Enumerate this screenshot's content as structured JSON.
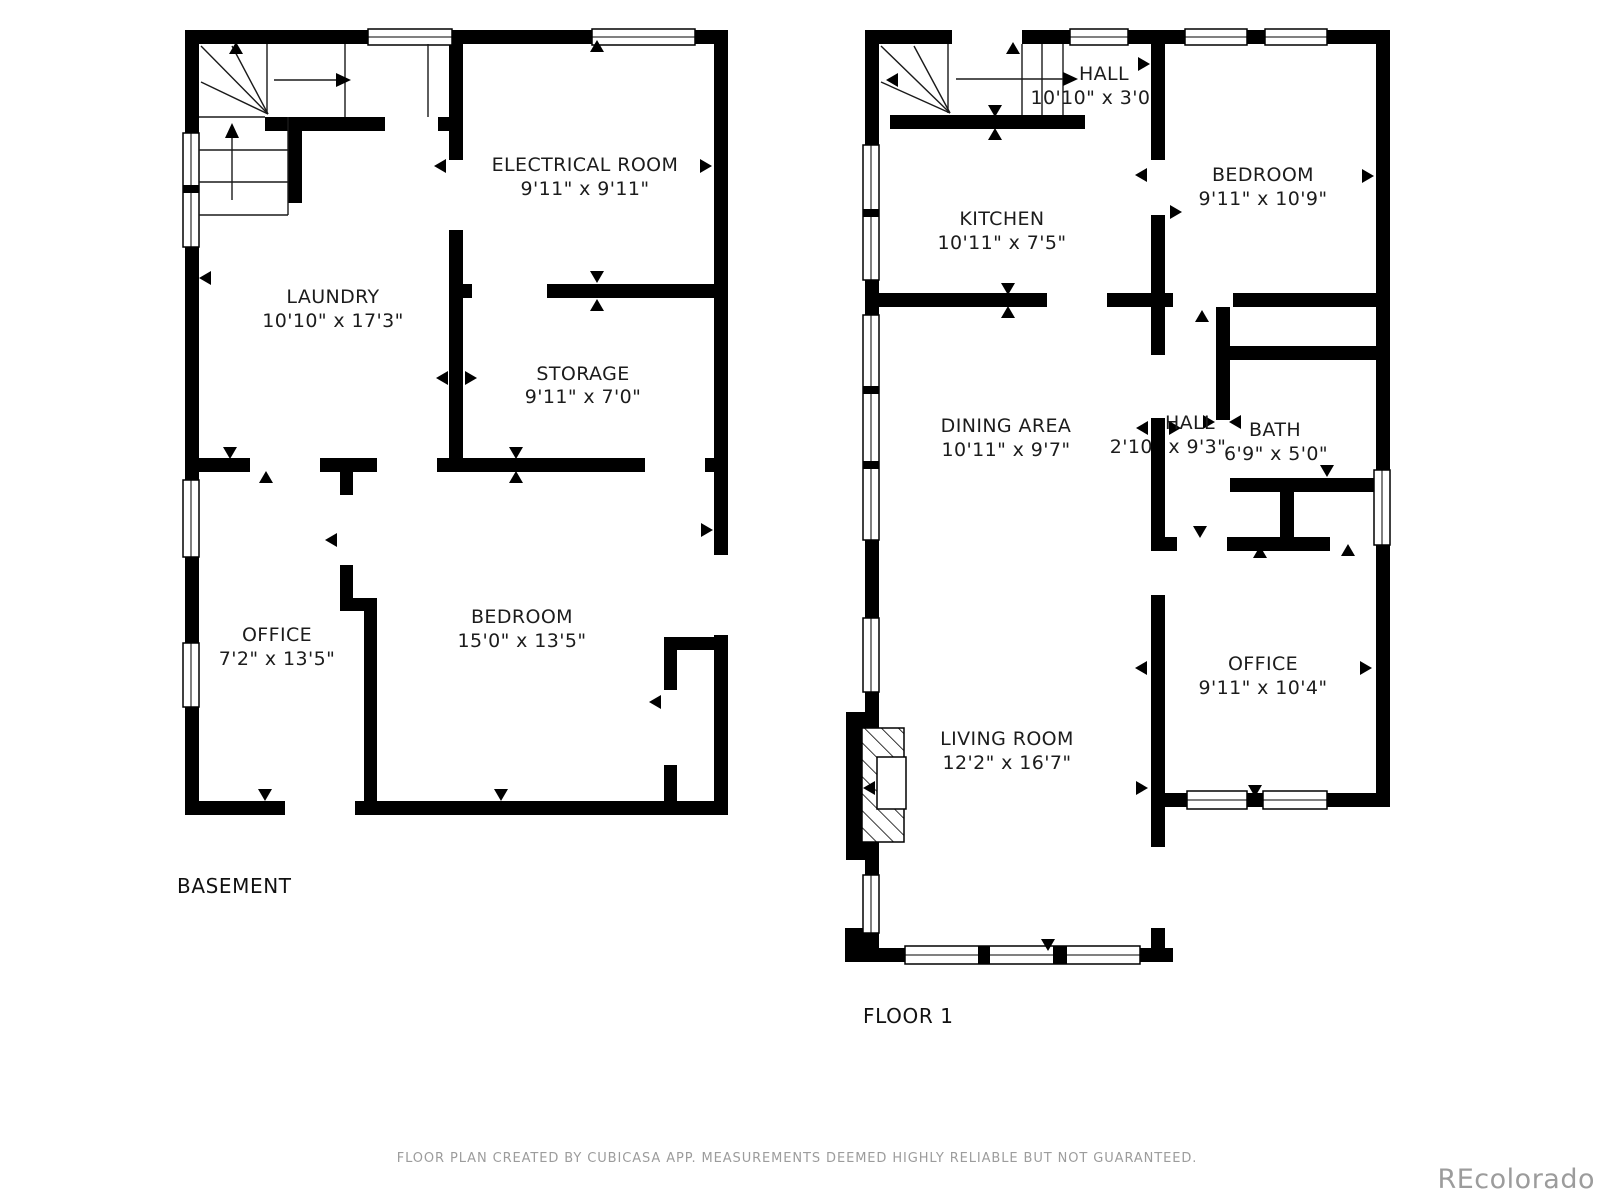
{
  "plans": [
    {
      "title": "BASEMENT",
      "rooms": [
        {
          "name": "ELECTRICAL ROOM",
          "dims": "9'11\" x 9'11\""
        },
        {
          "name": "STORAGE",
          "dims": "9'11\" x 7'0\""
        },
        {
          "name": "LAUNDRY",
          "dims": "10'10\" x 17'3\""
        },
        {
          "name": "OFFICE",
          "dims": "7'2\" x 13'5\""
        },
        {
          "name": "BEDROOM",
          "dims": "15'0\" x 13'5\""
        }
      ]
    },
    {
      "title": "FLOOR 1",
      "rooms": [
        {
          "name": "HALL",
          "dims": "10'10\" x 3'0\""
        },
        {
          "name": "KITCHEN",
          "dims": "10'11\" x 7'5\""
        },
        {
          "name": "BEDROOM",
          "dims": "9'11\" x 10'9\""
        },
        {
          "name": "DINING AREA",
          "dims": "10'11\" x 9'7\""
        },
        {
          "name": "HALL",
          "dims": "2'10\" x 9'3\""
        },
        {
          "name": "BATH",
          "dims": "6'9\" x 5'0\""
        },
        {
          "name": "OFFICE",
          "dims": "9'11\" x 10'4\""
        },
        {
          "name": "LIVING ROOM",
          "dims": "12'2\" x 16'7\""
        }
      ]
    }
  ],
  "footer": {
    "disclaimer": "FLOOR PLAN CREATED BY CUBICASA APP. MEASUREMENTS DEEMED HIGHLY RELIABLE BUT NOT GUARANTEED.",
    "watermark": "REcolorado"
  },
  "colors": {
    "wall": "#000000",
    "label": "#1c1c1c",
    "muted": "#9c9c9c",
    "background": "#ffffff"
  }
}
